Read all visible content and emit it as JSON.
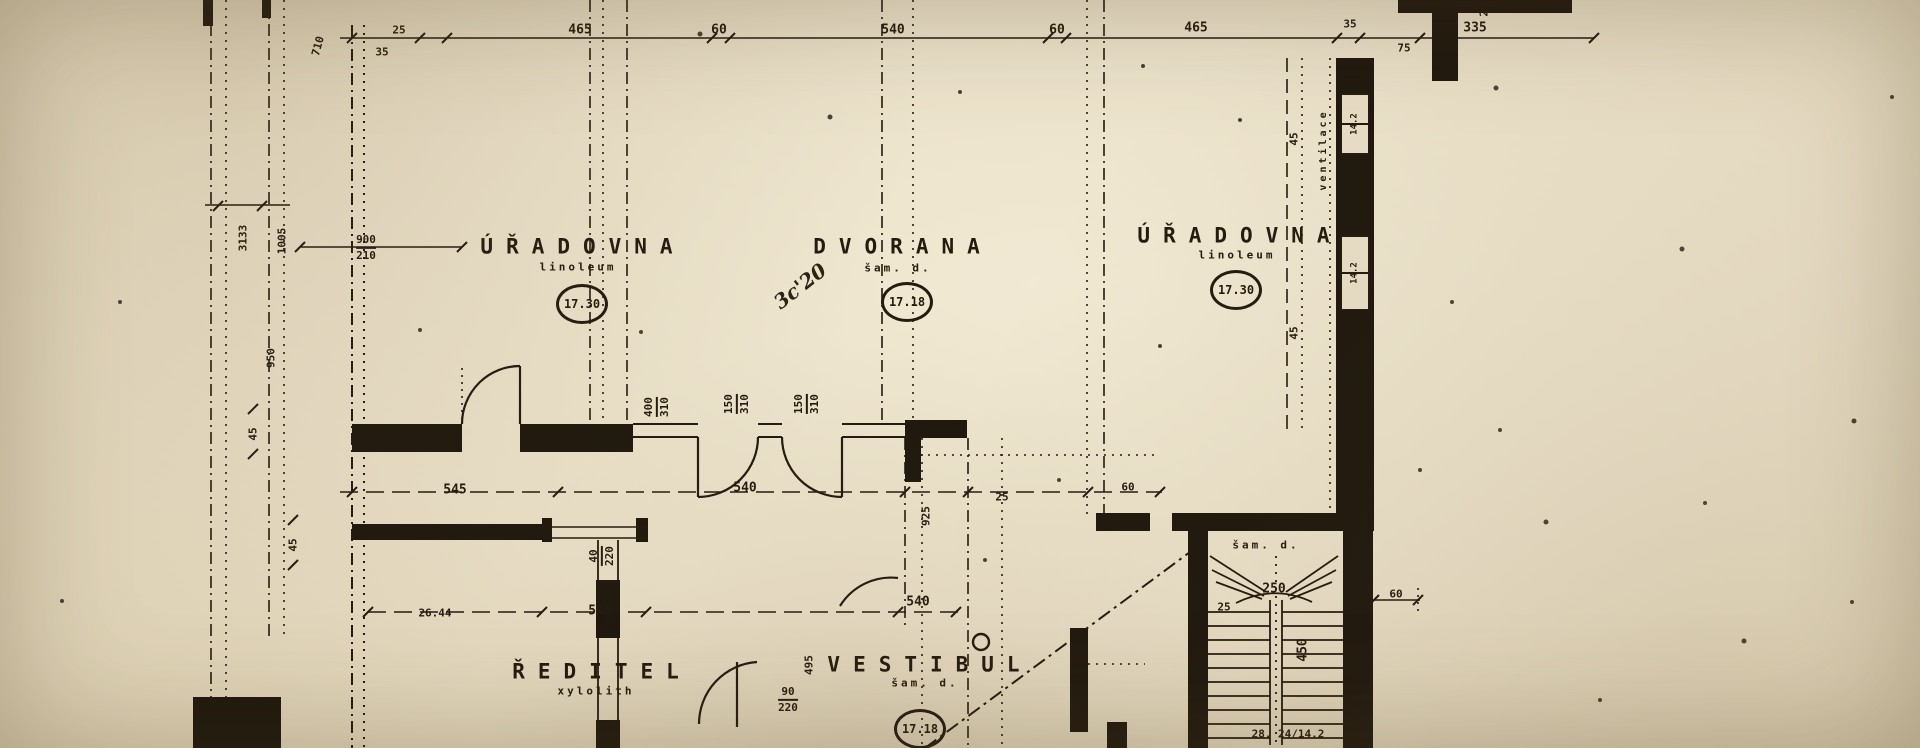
{
  "plan": {
    "rooms": {
      "office_left": {
        "name": "ÚŘADOVNA",
        "floor": "linoleum",
        "level": "17.30"
      },
      "hall": {
        "name": "DVORANA",
        "floor": "šam. d.",
        "level": "17.18"
      },
      "office_right": {
        "name": "ÚŘADOVNA",
        "floor": "linoleum",
        "level": "17.30"
      },
      "director": {
        "name": "ŘEDITEL",
        "floor": "xylolith"
      },
      "vestibule": {
        "name": "VESTIBUL",
        "floor": "šam. d.",
        "level": "17.18"
      },
      "staircase": {
        "floor": "šam. d.",
        "steps_note": "28. 24/14.2",
        "flight_length": "450",
        "landing": "250",
        "tread": "25"
      }
    },
    "dims_top": {
      "a": "25",
      "b": "35",
      "c": "465",
      "d": "60",
      "e": "540",
      "f": "60",
      "g": "465",
      "h": "35",
      "i": "75",
      "j": "335",
      "k": "25"
    },
    "dims_left": {
      "a": "710",
      "b": "3133",
      "c": "1005",
      "d": "950",
      "e": "45",
      "f": "45"
    },
    "dims_mid": {
      "a": "545",
      "b": "540",
      "c": "925",
      "d": "25",
      "e": "60",
      "f": "26.44",
      "g": "545",
      "h": "540",
      "i": "60"
    },
    "dims_right": {
      "a": "45",
      "b": "45"
    },
    "door_dims": {
      "left_office_door": {
        "num": "900",
        "den": "210"
      },
      "hall_door_a": {
        "num": "400",
        "den": "310"
      },
      "hall_door_b": {
        "num": "150",
        "den": "310"
      },
      "hall_door_c": {
        "num": "150",
        "den": "310"
      },
      "director_door": {
        "num": "40",
        "den": "220"
      },
      "vestibule_door": {
        "num": "90",
        "den": "220"
      },
      "vestibule_door_height": "495"
    },
    "annotations": {
      "ventilation": "ventilace",
      "vent_box_1": "14.2",
      "vent_box_2": "14.2",
      "handwritten": "3c'20"
    }
  }
}
